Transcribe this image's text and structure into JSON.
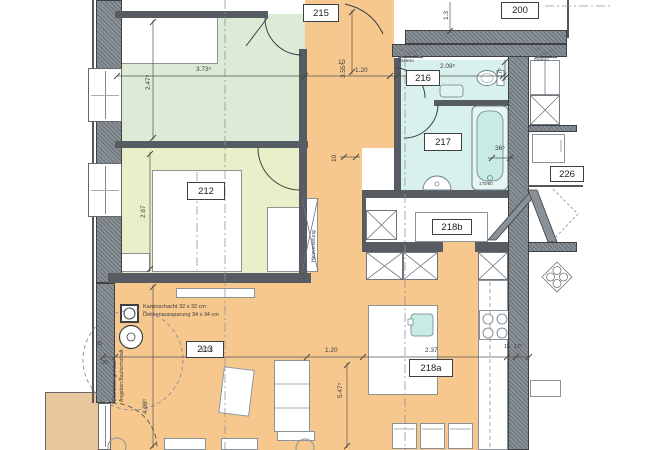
{
  "drawing": {
    "type": "architectural floor plan (apartment)",
    "rooms": {
      "r215": "215",
      "r200": "200",
      "r216": "216",
      "r217": "217",
      "r226": "226",
      "r212": "212",
      "r218b": "218b",
      "r213": "213",
      "r218a": "218a"
    },
    "dims": {
      "d_room_top_w": "3.73⁵",
      "d_room_top_h": "2.47⁵",
      "d_corr_h": "3.55⁵",
      "d_corr_w": "1.20",
      "d_wall10_top": "10",
      "d_216_w": "2.09⁵",
      "d_13": "1.3",
      "d_216_h": "17⁵",
      "d_wall36": "36⁵",
      "d_212_h": "2.67",
      "d_wall10_mid": "10",
      "d_213_w": "3.71",
      "d_213_h": "4.98⁵",
      "d_120b": "1.20",
      "d_island": "2.37",
      "d_218a_h": "5.47⁵",
      "d_15": "15",
      "d_17b": "17⁵",
      "d_20": "20",
      "d_25": "25",
      "d_tub": "170/80"
    },
    "annotations": {
      "kamin": "Kaminschacht 32 x 32 cm",
      "decke": "Deckenaussparung 34 x 34 cm",
      "chem1": "Cheminée gemäss",
      "chem2": "Angaben Bauherrschaft",
      "heiz": "Heizverteilung",
      "elektro_a": "Elektro",
      "elektro_b": "Elektro"
    },
    "colors": {
      "corridor": "#f6c88e",
      "balcony": "#e9c79c",
      "bedroom_top": "#dcead6",
      "bedroom_212": "#e9efc8",
      "bathroom": "#d9f1ed",
      "fixture": "#c9ebe6",
      "wall": "#8a9197",
      "wall_dark": "#565c61",
      "line": "#444444"
    }
  }
}
